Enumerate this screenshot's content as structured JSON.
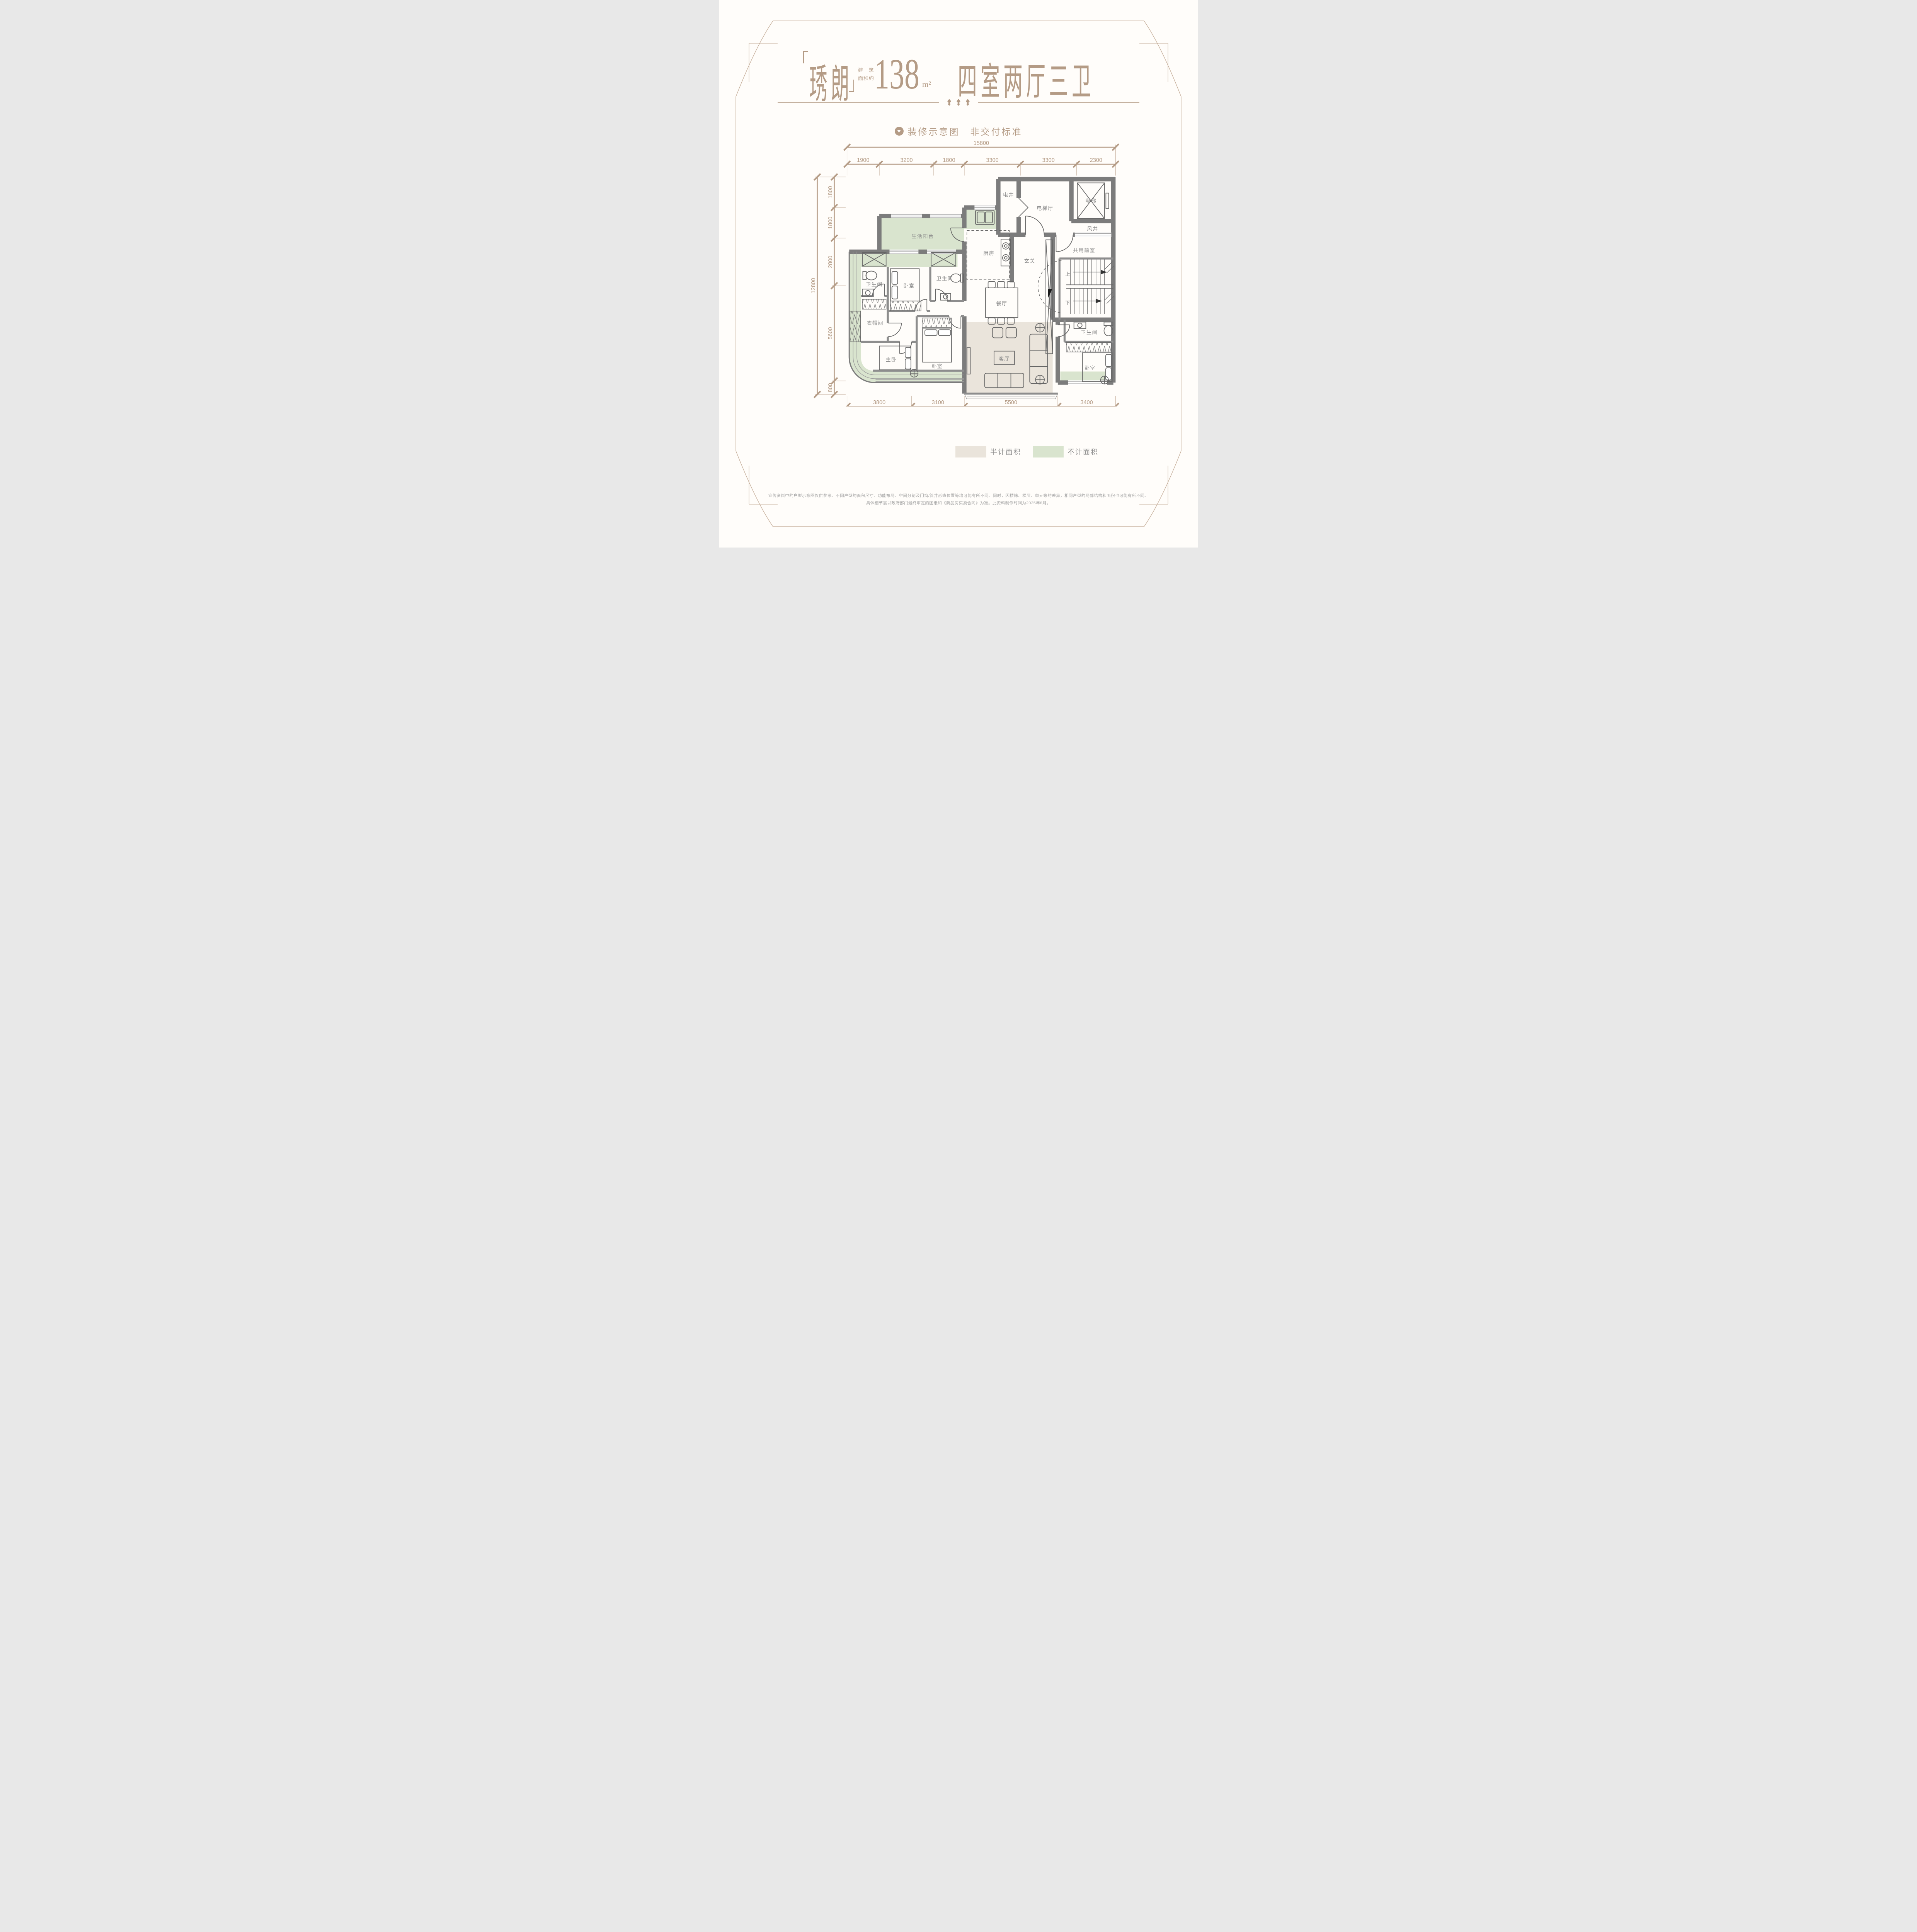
{
  "header": {
    "brand": "琇朗",
    "area_label_line1": "建　筑",
    "area_label_line2": "面积约",
    "area_value": "138",
    "area_unit": "m²",
    "unit_type": "四室两厅三卫",
    "note": "装修示意图　非交付标准"
  },
  "dimensions": {
    "top": {
      "total": "15800",
      "segments": [
        "1900",
        "3200",
        "1800",
        "3300",
        "3300",
        "2300"
      ]
    },
    "left": {
      "total": "12800",
      "segments": [
        "1800",
        "1800",
        "2800",
        "5600",
        "800"
      ]
    },
    "bottom": {
      "total": "15800",
      "segments": [
        "3800",
        "3100",
        "5500",
        "3400"
      ]
    }
  },
  "plan": {
    "rooms": {
      "elec_shaft": "电井",
      "elevator_hall": "电梯厅",
      "elevator": "电梯",
      "air_shaft": "风井",
      "shared_front_room": "共用前室",
      "foyer": "玄关",
      "kitchen": "厨房",
      "service_balcony": "生活阳台",
      "dining": "餐厅",
      "living": "客厅",
      "bathroom": "卫生间",
      "cloakroom": "衣帽间",
      "master_bedroom": "主卧",
      "bedroom": "卧室",
      "stairs_up": "上",
      "stairs_down": "下"
    }
  },
  "legend": {
    "half": {
      "label": "半计面积",
      "color": "#eae4db"
    },
    "excluded": {
      "label": "不计面积",
      "color": "#d9e4ce"
    }
  },
  "footer": {
    "line1": "宣传资料中的户型示意图仅供参考。不同户型的面积尺寸、功能布局、空间分割及门窗/管井形态位置等均可能有所不同。同时，因楼栋、楼层、单元等的差异，相同户型的局部结构和面积也可能有所不同。",
    "line2": "具体细节需以政府部门最终审定的图纸和《商品房买卖合同》为准。此资料制作时间为2025年8月。"
  },
  "colors": {
    "accent": "#b49b85",
    "wall": "#7c7c7c",
    "room_label": "#8b8b8b",
    "half_area": "#eae4db",
    "excluded_area": "#d9e4ce"
  }
}
